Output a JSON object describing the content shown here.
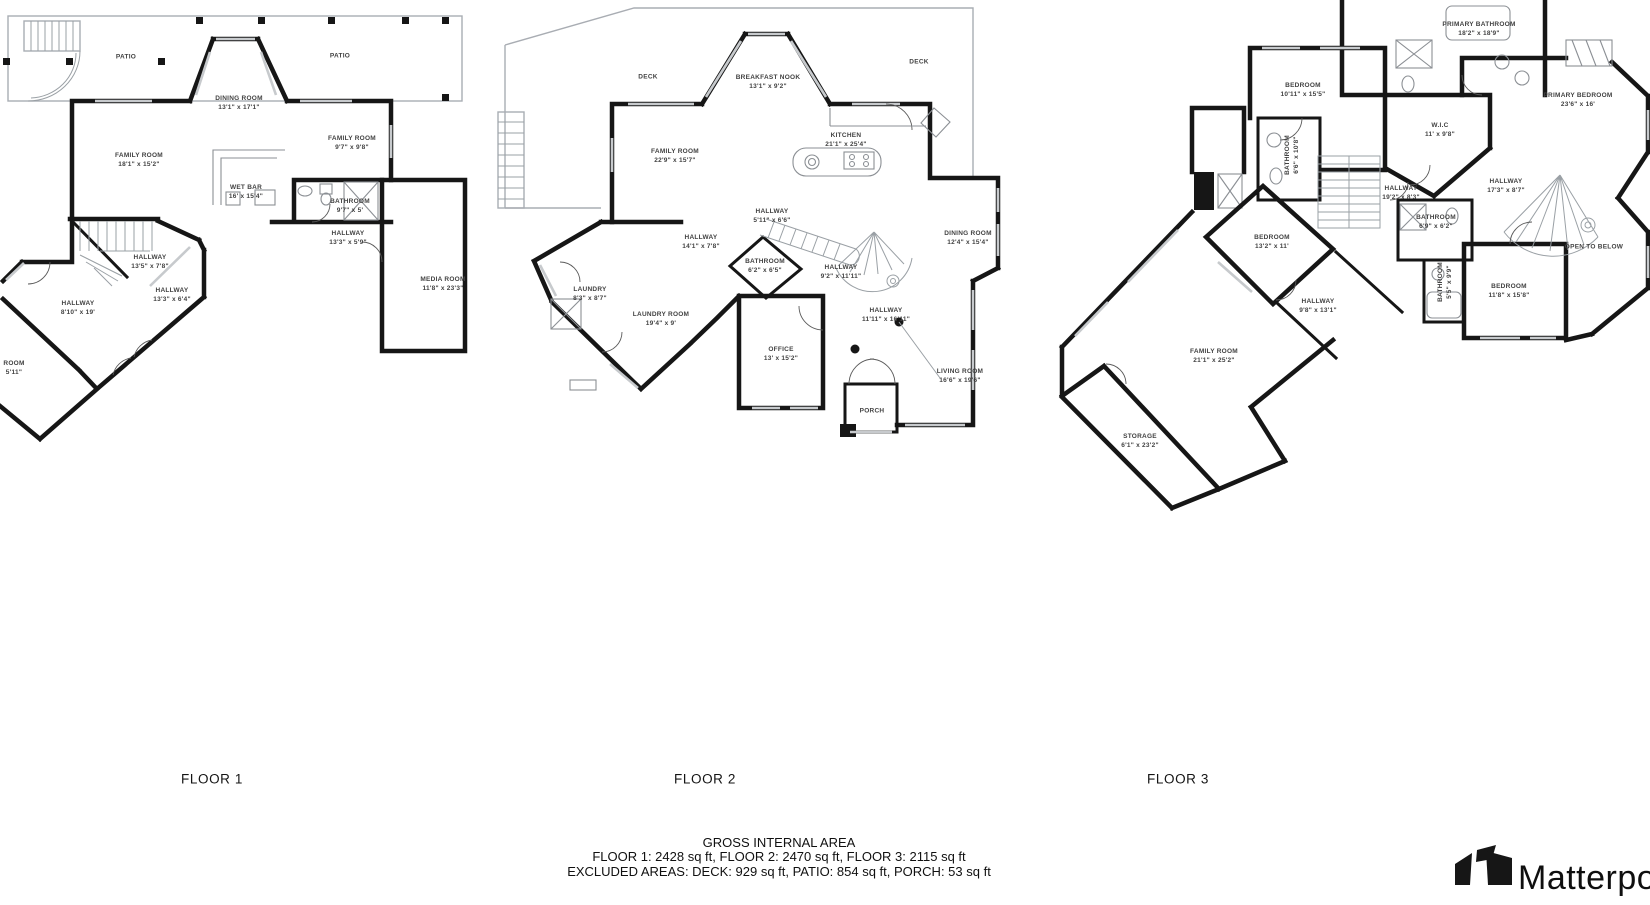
{
  "floors": [
    {
      "id": "floor-1",
      "caption": "FLOOR 1",
      "caption_x": 212,
      "caption_y": 779,
      "rooms": [
        {
          "n": "PATIO",
          "d": "",
          "x": 126,
          "y": 57
        },
        {
          "n": "PATIO",
          "d": "",
          "x": 340,
          "y": 56
        },
        {
          "n": "DINING ROOM",
          "d": "13'1\" x 17'1\"",
          "x": 239,
          "y": 103
        },
        {
          "n": "FAMILY ROOM",
          "d": "18'1\" x 15'2\"",
          "x": 139,
          "y": 160
        },
        {
          "n": "FAMILY ROOM",
          "d": "9'7\" x 9'8\"",
          "x": 352,
          "y": 143
        },
        {
          "n": "WET BAR",
          "d": "16' x 15'4\"",
          "x": 246,
          "y": 192
        },
        {
          "n": "BATHROOM",
          "d": "9'7\" x 5'",
          "x": 350,
          "y": 206
        },
        {
          "n": "HALLWAY",
          "d": "13'3\" x 5'9\"",
          "x": 348,
          "y": 238
        },
        {
          "n": "HALLWAY",
          "d": "13'5\" x 7'8\"",
          "x": 150,
          "y": 262
        },
        {
          "n": "HALLWAY",
          "d": "13'3\" x 6'4\"",
          "x": 172,
          "y": 295
        },
        {
          "n": "HALLWAY",
          "d": "8'10\" x 19'",
          "x": 78,
          "y": 308
        },
        {
          "n": "MEDIA ROOM",
          "d": "11'8\" x 23'3\"",
          "x": 443,
          "y": 284
        },
        {
          "n": "ROOM",
          "d": "5'11\"",
          "x": 14,
          "y": 368
        }
      ]
    },
    {
      "id": "floor-2",
      "caption": "FLOOR 2",
      "caption_x": 705,
      "caption_y": 779,
      "rooms": [
        {
          "n": "DECK",
          "d": "",
          "x": 648,
          "y": 77
        },
        {
          "n": "BREAKFAST NOOK",
          "d": "13'1\" x 9'2\"",
          "x": 768,
          "y": 82
        },
        {
          "n": "DECK",
          "d": "",
          "x": 919,
          "y": 62
        },
        {
          "n": "FAMILY ROOM",
          "d": "22'9\" x 15'7\"",
          "x": 675,
          "y": 156
        },
        {
          "n": "KITCHEN",
          "d": "21'1\" x 25'4\"",
          "x": 846,
          "y": 140
        },
        {
          "n": "HALLWAY",
          "d": "5'11\" x 6'6\"",
          "x": 772,
          "y": 216
        },
        {
          "n": "HALLWAY",
          "d": "14'1\" x 7'8\"",
          "x": 701,
          "y": 242
        },
        {
          "n": "DINING ROOM",
          "d": "12'4\" x 15'4\"",
          "x": 968,
          "y": 238
        },
        {
          "n": "BATHROOM",
          "d": "6'2\" x 6'5\"",
          "x": 765,
          "y": 266
        },
        {
          "n": "HALLWAY",
          "d": "9'2\" x 11'11\"",
          "x": 841,
          "y": 272
        },
        {
          "n": "LAUNDRY",
          "d": "8'3\" x 8'7\"",
          "x": 590,
          "y": 294
        },
        {
          "n": "LAUNDRY ROOM",
          "d": "19'4\" x 9'",
          "x": 661,
          "y": 319
        },
        {
          "n": "HALLWAY",
          "d": "11'11\" x 16'11\"",
          "x": 886,
          "y": 315
        },
        {
          "n": "OFFICE",
          "d": "13' x 15'2\"",
          "x": 781,
          "y": 354
        },
        {
          "n": "LIVING ROOM",
          "d": "16'6\" x 19'6\"",
          "x": 960,
          "y": 376
        },
        {
          "n": "PORCH",
          "d": "",
          "x": 872,
          "y": 411
        }
      ]
    },
    {
      "id": "floor-3",
      "caption": "FLOOR 3",
      "caption_x": 1178,
      "caption_y": 779,
      "rooms": [
        {
          "n": "PRIMARY BATHROOM",
          "d": "18'2\" x 18'9\"",
          "x": 1479,
          "y": 29
        },
        {
          "n": "BEDROOM",
          "d": "10'11\" x 15'5\"",
          "x": 1303,
          "y": 90
        },
        {
          "n": "PRIMARY BEDROOM",
          "d": "23'6\" x 16'",
          "x": 1578,
          "y": 100
        },
        {
          "n": "W.I.C",
          "d": "11' x 9'8\"",
          "x": 1440,
          "y": 130
        },
        {
          "n": "BATHROOM",
          "d": "6'6\" x 10'8\"",
          "x": 1292,
          "y": 155,
          "r": -90
        },
        {
          "n": "HALLWAY",
          "d": "19'2\" x 8'3\"",
          "x": 1401,
          "y": 193
        },
        {
          "n": "HALLWAY",
          "d": "17'3\" x 8'7\"",
          "x": 1506,
          "y": 186
        },
        {
          "n": "BATHROOM",
          "d": "6'9\" x 6'2\"",
          "x": 1436,
          "y": 222
        },
        {
          "n": "BEDROOM",
          "d": "13'2\" x 11'",
          "x": 1272,
          "y": 242
        },
        {
          "n": "OPEN TO BELOW",
          "d": "",
          "x": 1594,
          "y": 247
        },
        {
          "n": "BATHROOM",
          "d": "5'5\" x 9'9\"",
          "x": 1445,
          "y": 282,
          "r": -90
        },
        {
          "n": "HALLWAY",
          "d": "9'8\" x 13'1\"",
          "x": 1318,
          "y": 306
        },
        {
          "n": "BEDROOM",
          "d": "11'8\" x 15'8\"",
          "x": 1509,
          "y": 291
        },
        {
          "n": "FAMILY ROOM",
          "d": "21'1\" x 25'2\"",
          "x": 1214,
          "y": 356
        },
        {
          "n": "STORAGE",
          "d": "6'1\" x 23'2\"",
          "x": 1140,
          "y": 441
        }
      ]
    }
  ],
  "footer": {
    "title": "GROSS INTERNAL AREA",
    "line1": "FLOOR 1: 2428 sq ft, FLOOR 2: 2470 sq ft, FLOOR 3: 2115 sq ft",
    "line2": "EXCLUDED AREAS: DECK: 929 sq ft, PATIO: 854 sq ft, PORCH: 53 sq ft"
  },
  "logo": {
    "brand": "Matterport"
  }
}
